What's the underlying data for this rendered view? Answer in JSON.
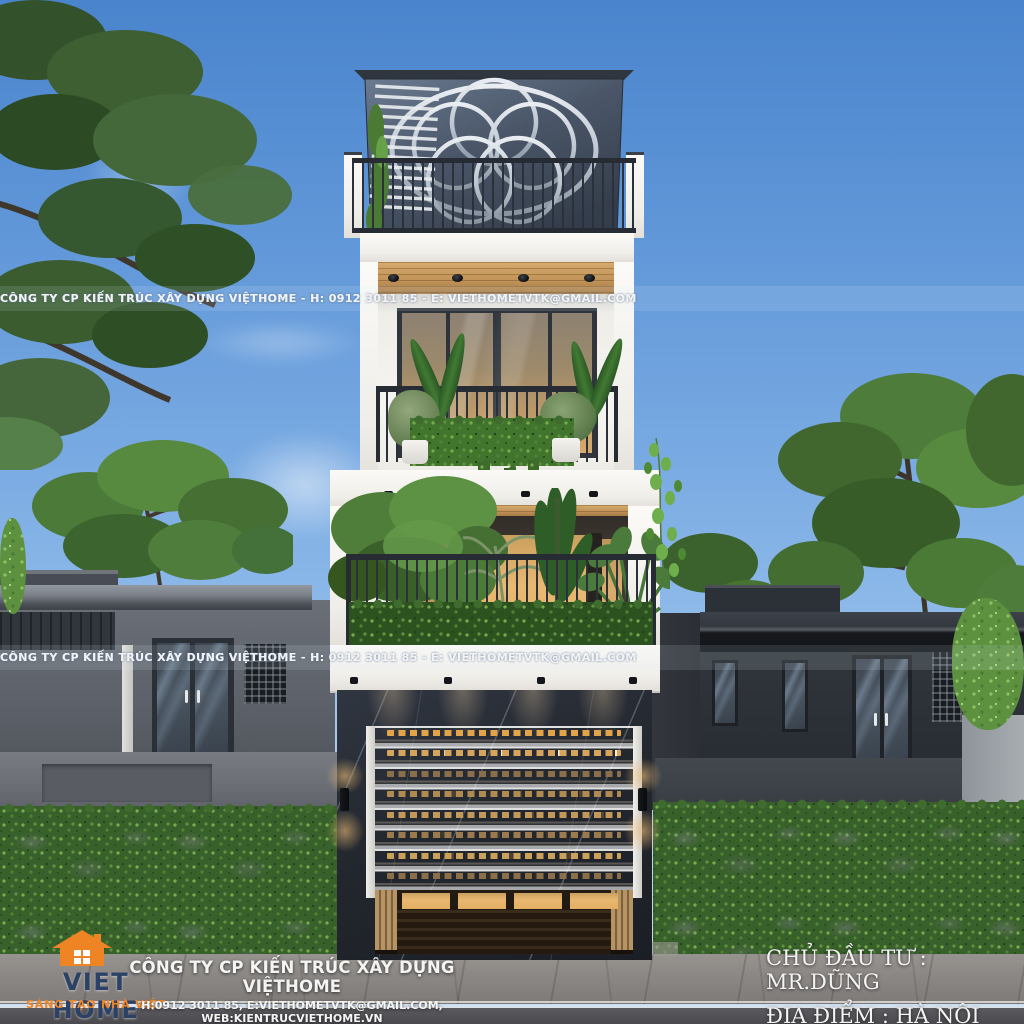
{
  "scene": {
    "description": "Front elevation 3D render of a narrow 4-level modern townhouse with rooftop circular metal screen, plant-filled balconies, dark marble garage level with white roller door, flanked by grey single-storey houses, green hedges and street",
    "colors": {
      "sky_top": "#4a84cc",
      "sky_bottom": "#cfe0f5",
      "wall_white": "#f4f2ee",
      "wood_soffit": "#c2945a",
      "window_glow": "#e9b871",
      "marble_dark": "#23272e",
      "hedge_green": "#38602a",
      "left_house_grey": "#61666e",
      "right_house_grey": "#2b3036",
      "pavement_grey": "#8b8784",
      "road_grey": "#4b4a4e",
      "logo_navy": "#2c4166",
      "logo_orange": "#ee8424"
    }
  },
  "watermark": {
    "text": "CÔNG TY CP KIẾN TRÚC XÂY DỰNG VIỆTHOME  -  H: 0912 3011 85  -  E: VIETHOMETVTK@GMAIL.COM"
  },
  "logo": {
    "name": "VIET HOME",
    "tagline": "SÁNG TẠO NHÀ VIỆT"
  },
  "footer": {
    "company_name": "CÔNG TY CP KIẾN TRÚC XÂY DỰNG VIỆTHOME",
    "contact_line": "H:0912 3011 85, E:VIETHOMETVTK@GMAIL.COM, WEB:KIENTRUCVIETHOME.VN"
  },
  "project": {
    "investor": "CHỦ ĐẦU TƯ : MR.DŨNG",
    "location": "ĐỊA ĐIỂM :  HÀ NỘI"
  }
}
